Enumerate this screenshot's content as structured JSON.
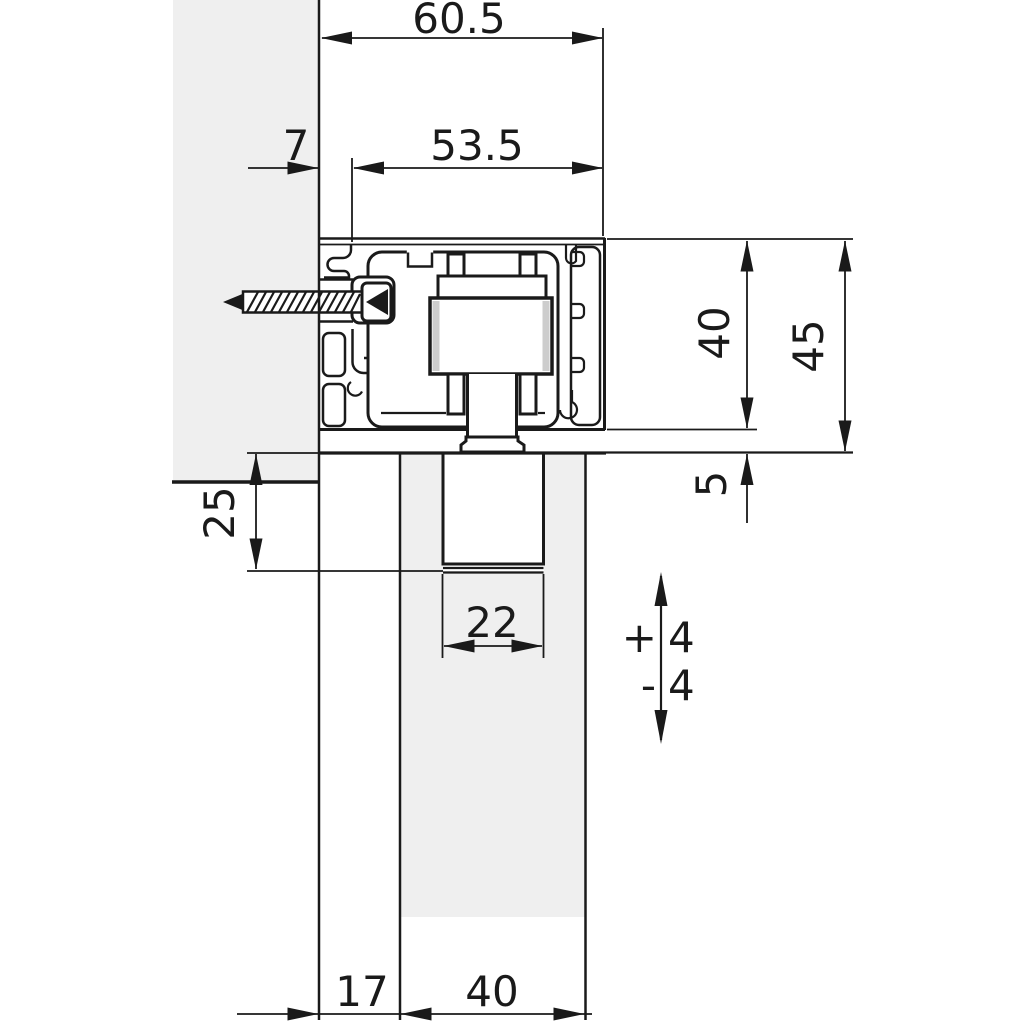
{
  "figure": {
    "colors": {
      "line": "#1a1a1a",
      "material": "#efefef",
      "background": "#ffffff",
      "roller_shading": "#cdcdcd"
    },
    "dimensions": {
      "overall_width": "60.5",
      "inner_width": "53.5",
      "wall_offset": "7",
      "track_height": "40",
      "total_height": "45",
      "clearance": "5",
      "side_inset": "25",
      "bracket_width": "22",
      "adjust_up_sign": "+",
      "adjust_up_value": "4",
      "adjust_down_sign": "-",
      "adjust_down_value": "4",
      "floor_gap": "17",
      "door_thickness": "40"
    }
  }
}
